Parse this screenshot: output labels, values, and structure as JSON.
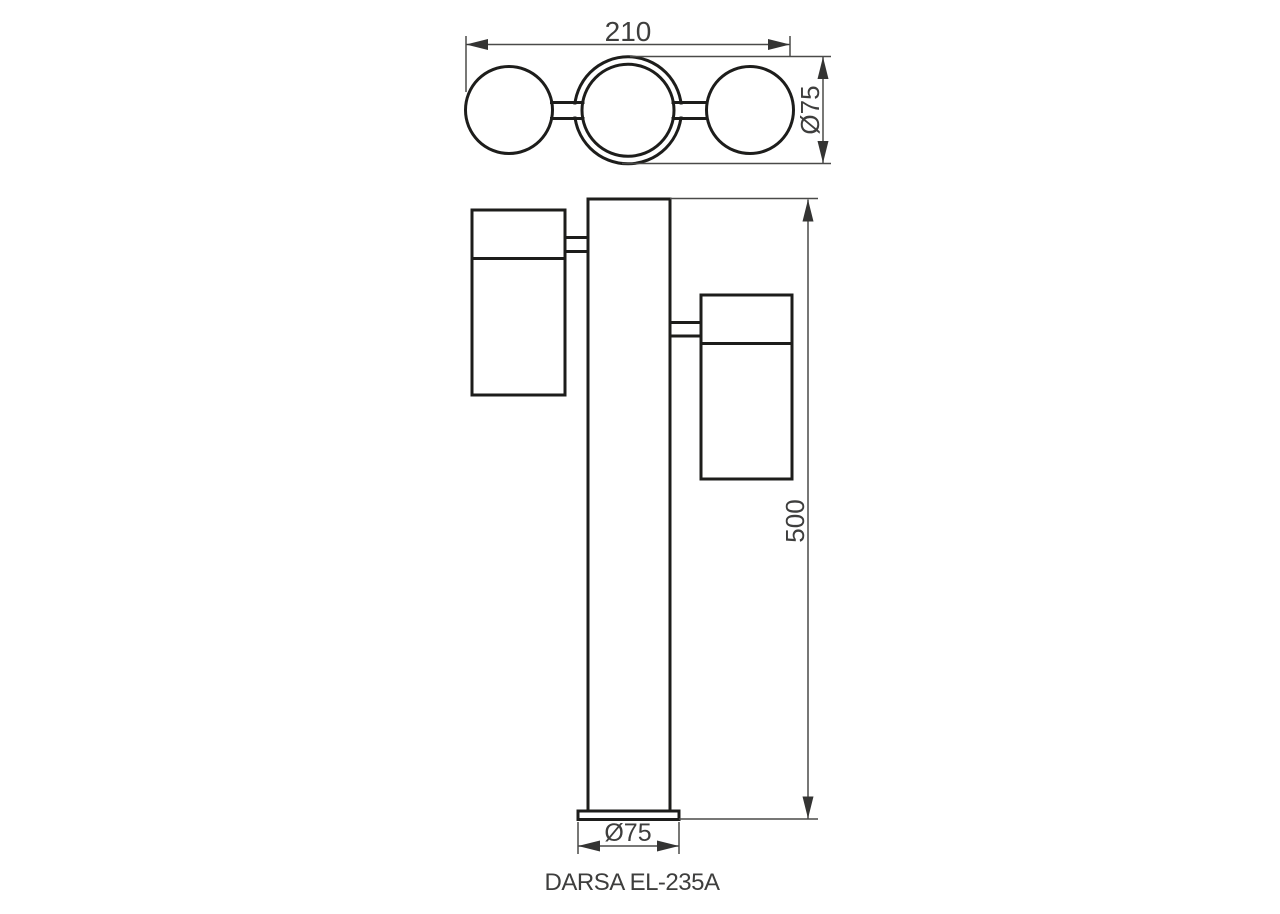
{
  "drawing": {
    "product_label": "DARSA EL-235A",
    "dimensions": {
      "top_width": "210",
      "head_diameter": "Ø75",
      "pole_height": "500",
      "base_diameter": "Ø75"
    }
  },
  "colors": {
    "outline": "#1d1d1b",
    "dimension_line": "#4a4a49",
    "text": "#3e3e3d",
    "background": "#ffffff"
  }
}
